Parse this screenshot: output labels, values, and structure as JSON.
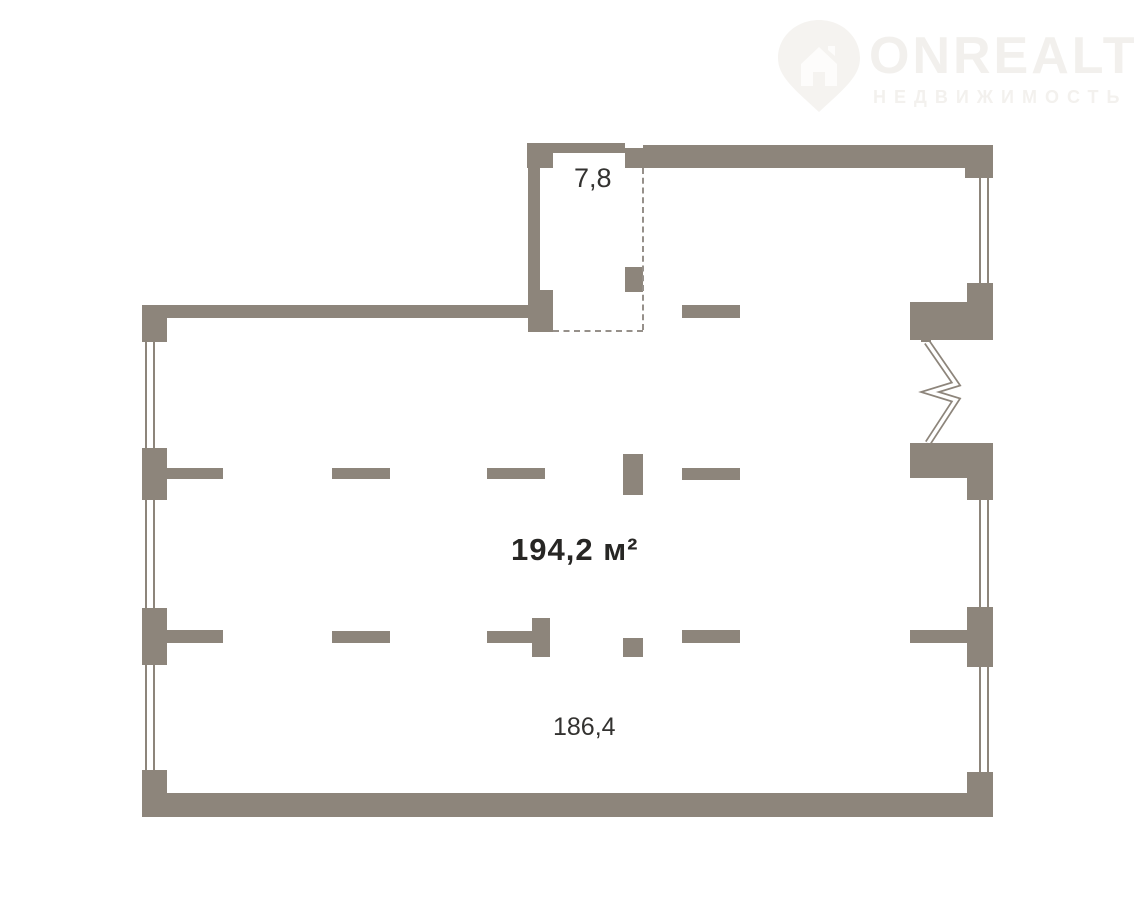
{
  "watermark": {
    "brand": "ONREALT",
    "subtitle": "НЕДВИЖИМОСТЬ",
    "brand_color": "#f2f0ed",
    "pin_color": "#f5f3f0",
    "pin_icon": "location-pin-house-icon"
  },
  "colors": {
    "wall": "#8d857b",
    "dashed_line": "#96908a",
    "label_text": "#2f2e2c",
    "background": "#ffffff"
  },
  "plan": {
    "labels": {
      "room_small_area": "7,8",
      "total_area": "194,2 м²",
      "main_area": "186,4"
    },
    "walls": [
      [
        527,
        143,
        26,
        25
      ],
      [
        553,
        143,
        72,
        10
      ],
      [
        625,
        148,
        18,
        20
      ],
      [
        643,
        145,
        322,
        23
      ],
      [
        965,
        145,
        28,
        33
      ],
      [
        528,
        143,
        12,
        162
      ],
      [
        528,
        290,
        25,
        42
      ],
      [
        625,
        267,
        18,
        25
      ],
      [
        142,
        305,
        386,
        13
      ],
      [
        142,
        305,
        25,
        37
      ],
      [
        142,
        448,
        25,
        52
      ],
      [
        142,
        608,
        25,
        57
      ],
      [
        142,
        770,
        25,
        47
      ],
      [
        142,
        793,
        851,
        24
      ],
      [
        967,
        283,
        26,
        20
      ],
      [
        910,
        302,
        83,
        38
      ],
      [
        910,
        443,
        83,
        35
      ],
      [
        967,
        478,
        26,
        22
      ],
      [
        967,
        607,
        26,
        60
      ],
      [
        910,
        630,
        57,
        13
      ],
      [
        967,
        772,
        26,
        45
      ],
      [
        921,
        334,
        10,
        8
      ],
      [
        921,
        443,
        10,
        7
      ],
      [
        682,
        305,
        58,
        13
      ],
      [
        165,
        468,
        58,
        11
      ],
      [
        332,
        468,
        58,
        11
      ],
      [
        487,
        468,
        58,
        11
      ],
      [
        682,
        468,
        58,
        12
      ],
      [
        623,
        454,
        20,
        41
      ],
      [
        165,
        630,
        58,
        13
      ],
      [
        332,
        631,
        58,
        12
      ],
      [
        487,
        631,
        45,
        12
      ],
      [
        532,
        618,
        18,
        39
      ],
      [
        623,
        638,
        20,
        19
      ],
      [
        682,
        630,
        58,
        13
      ]
    ],
    "window_lines": [
      [
        145,
        342,
        2,
        106
      ],
      [
        153,
        342,
        2,
        106
      ],
      [
        145,
        500,
        2,
        108
      ],
      [
        153,
        500,
        2,
        108
      ],
      [
        145,
        665,
        2,
        105
      ],
      [
        153,
        665,
        2,
        105
      ],
      [
        979,
        178,
        2,
        105
      ],
      [
        987,
        178,
        2,
        105
      ],
      [
        979,
        500,
        2,
        107
      ],
      [
        987,
        500,
        2,
        107
      ],
      [
        979,
        667,
        2,
        105
      ],
      [
        987,
        667,
        2,
        105
      ]
    ],
    "dashed_lines": [
      {
        "orientation": "vertical",
        "x": 642,
        "y": 168,
        "length": 162
      },
      {
        "orientation": "horizontal",
        "x": 553,
        "y": 330,
        "length": 90
      }
    ],
    "zigzag_door": {
      "points": "927,342 956,384 930,392 956,400 928,443"
    }
  }
}
